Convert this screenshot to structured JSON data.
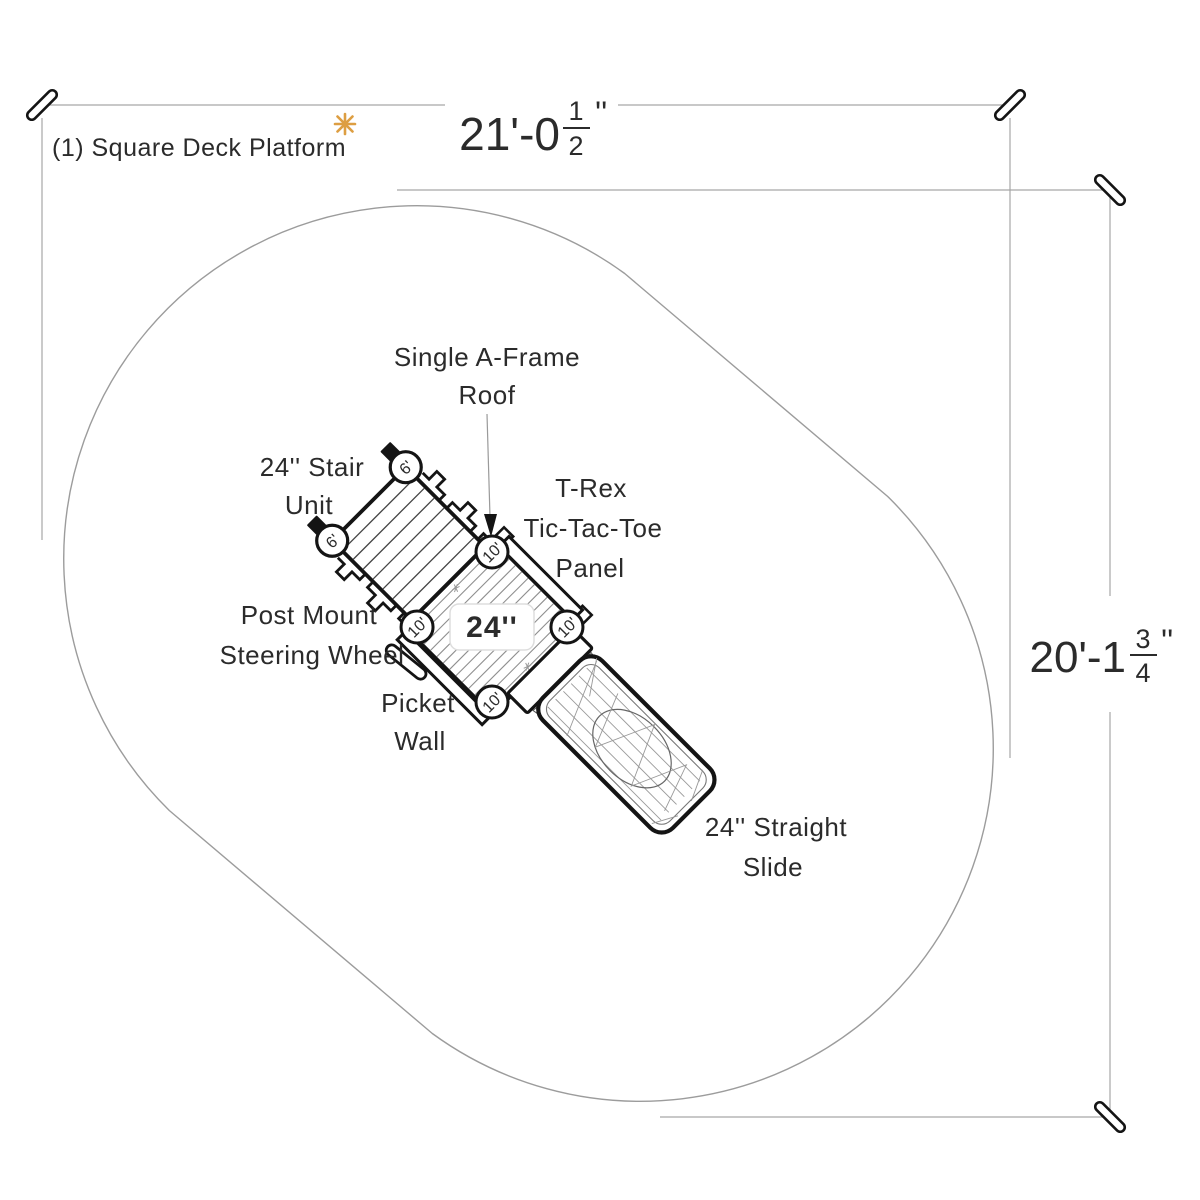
{
  "title": {
    "text": "(1) Square Deck Platform"
  },
  "dimensions": {
    "top": {
      "whole": "21'-0",
      "frac_num": "1",
      "frac_den": "2",
      "unit": "''"
    },
    "right": {
      "whole": "20'-1",
      "frac_num": "3",
      "frac_den": "4",
      "unit": "''"
    }
  },
  "callouts": {
    "roof": {
      "line1": "Single A-Frame",
      "line2": "Roof"
    },
    "stair": {
      "line1": "24'' Stair",
      "line2": "Unit"
    },
    "trex": {
      "line1": "T-Rex",
      "line2": "Tic-Tac-Toe",
      "line3": "Panel"
    },
    "steering": {
      "line1": "Post Mount",
      "line2": "Steering Wheel"
    },
    "picket": {
      "line1": "Picket",
      "line2": "Wall"
    },
    "slide": {
      "line1": "24'' Straight",
      "line2": "Slide"
    }
  },
  "deck": {
    "size_label": "24''",
    "post_marker": "10'",
    "stair_marker": "6'"
  },
  "colors": {
    "accent": "#c9973f",
    "asterisk": "#dd9e42",
    "ink": "#1a1a1a",
    "guide": "#a6a6a6"
  }
}
